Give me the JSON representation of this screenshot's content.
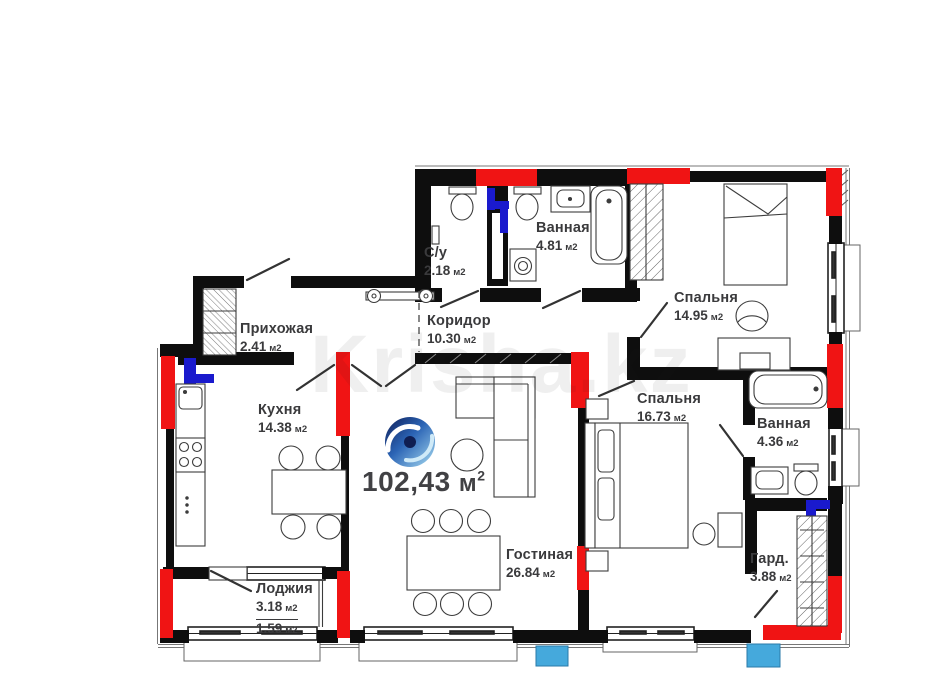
{
  "plan": {
    "watermark": "Krisha.kz",
    "total": {
      "value": "102,43",
      "unit": "м",
      "exp": "2"
    },
    "rooms": [
      {
        "id": "su",
        "name": "С/у",
        "area": "2.18",
        "unit": "м2"
      },
      {
        "id": "vannaya1",
        "name": "Ванная",
        "area": "4.81",
        "unit": "м2"
      },
      {
        "id": "spalnya1",
        "name": "Спальня",
        "area": "14.95",
        "unit": "м2"
      },
      {
        "id": "prihozhaya",
        "name": "Прихожая",
        "area": "2.41",
        "unit": "м2"
      },
      {
        "id": "koridor",
        "name": "Коридор",
        "area": "10.30",
        "unit": "м2"
      },
      {
        "id": "kuhnya",
        "name": "Кухня",
        "area": "14.38",
        "unit": "м2"
      },
      {
        "id": "spalnya2",
        "name": "Спальня",
        "area": "16.73",
        "unit": "м2"
      },
      {
        "id": "vannaya2",
        "name": "Ванная",
        "area": "4.36",
        "unit": "м2"
      },
      {
        "id": "gostinaya",
        "name": "Гостиная",
        "area": "26.84",
        "unit": "м2"
      },
      {
        "id": "garderob",
        "name": "Гард.",
        "area": "3.88",
        "unit": "м2"
      },
      {
        "id": "lodzhiya",
        "name": "Лоджия",
        "area": "3.18",
        "area2": "1.59",
        "unit": "м2"
      }
    ],
    "colors": {
      "wall": "#0e0e0e",
      "red_marker": "#f01414",
      "blue_marker": "#1a1acd",
      "balcony_block": "#45a9dc",
      "label_text": "#3a3a3c"
    }
  }
}
